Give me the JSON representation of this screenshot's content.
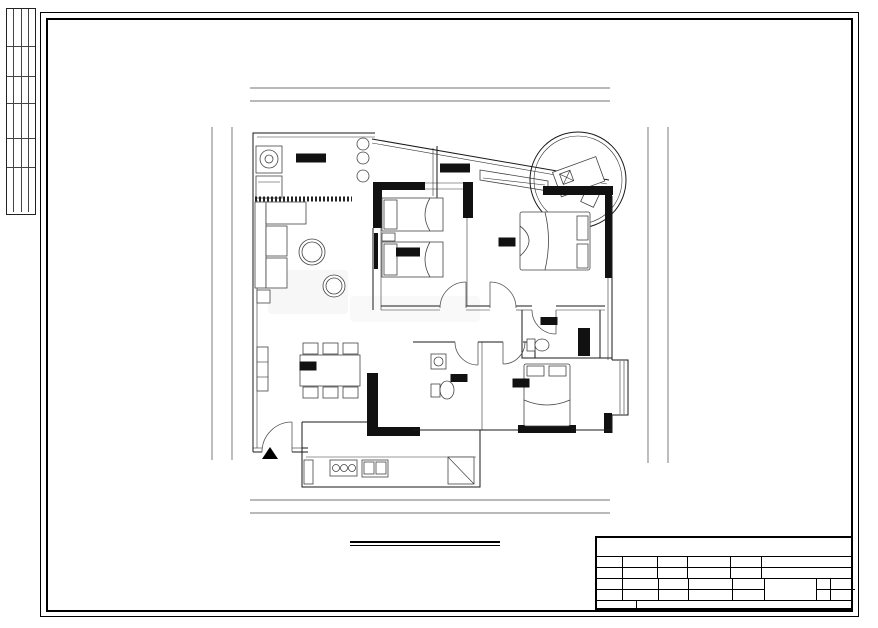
{
  "watermark": "由 Autodesk 教育版产品制作",
  "sheet_title": {
    "name": "平面布置图",
    "scale": "SC: 1/75"
  },
  "rooms": {
    "laundry_balcony": "洗衣阳台",
    "leisure_balcony": "休闲阳台",
    "children_room": "儿童房",
    "master_bedroom": "主卧",
    "master_bath": "主卫",
    "dining": "餐厅",
    "guest_bath": "客卫",
    "second_bedroom": "次卧",
    "entrance": "入户门"
  },
  "dims": {
    "top": {
      "overall": "12470",
      "segments": [
        "4040",
        "3050",
        "4050"
      ]
    },
    "bottom": {
      "overall": "12470",
      "segments": [
        "1470",
        "2250",
        "1720",
        "1830",
        "3420"
      ]
    },
    "left": {
      "overall": "12489",
      "segments": [
        "1830",
        "4310",
        "1000",
        "2359",
        "1820"
      ]
    },
    "right": {
      "overall": "12489",
      "segments": [
        "1830",
        "4310",
        "1000",
        "3370",
        "809"
      ]
    }
  },
  "countersign": {
    "cols": [
      "专业",
      "姓名",
      "签名",
      "日期"
    ],
    "bottom": [
      "建筑",
      "结构",
      "给排水",
      "电气"
    ]
  },
  "titleblock": {
    "company": "广东星艺装饰集团股份有限公司",
    "design_label": "设 计",
    "draft_label": "制 图",
    "quote_label": "报 价",
    "date_label": "日 期",
    "owner_label": "业主认可",
    "approve_label": "审 定",
    "check_label": "审 核",
    "scale_label": "比 例",
    "scale_value": "1:75",
    "project_label": "工程名称",
    "project_value": "逸翠华庭逸翠二街A栋2806号",
    "builder_label": "施工单位",
    "builder_value": "广东星艺装饰集团有限公司",
    "paper_label": "图 纸",
    "content_label": "内 容",
    "drawing_name": "平面布置图",
    "class_label": "图别",
    "class_value": "室内施",
    "no_label": "图号",
    "no_value": "P-04",
    "note_label": "设计说明",
    "cert_label": "施工图审查证书编号:",
    "cert_value": "A144016621(甲级)"
  }
}
